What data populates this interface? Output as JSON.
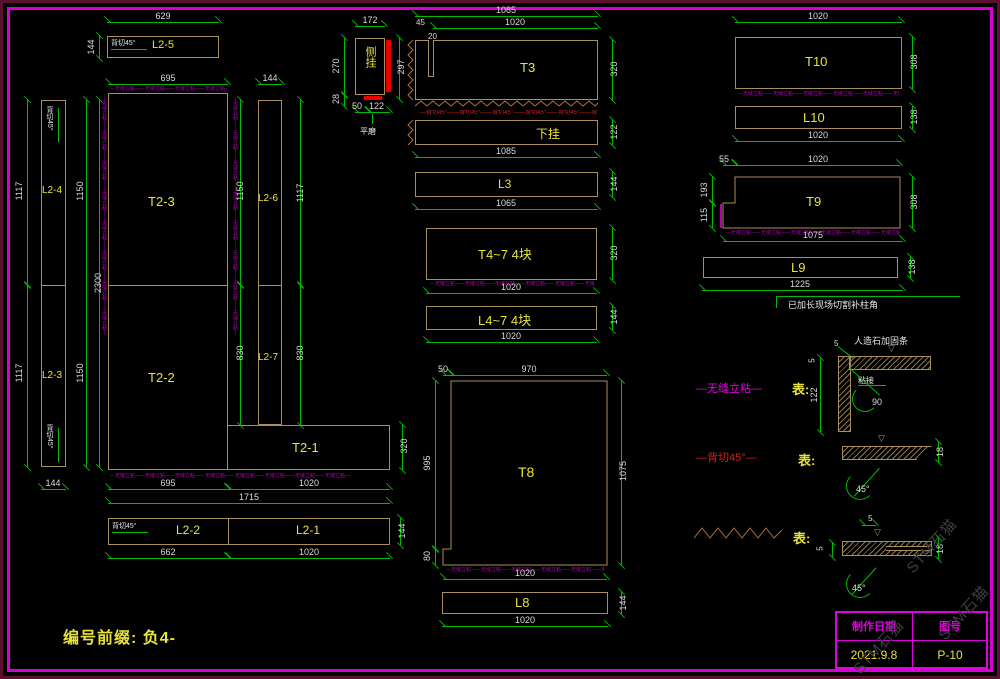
{
  "colors": {
    "background": "#000000",
    "border": "#d400d4",
    "outline": "#a98e5e",
    "dimension": "#00bb00",
    "dim_text": "#dcdcdc",
    "label": "#e8e23a",
    "seamless": "#b400b4",
    "backcut_red": "#cc2222",
    "zigzag": "#b0703a",
    "highlight_red": "#e80000"
  },
  "l25": {
    "label": "L2-5",
    "cut_note": "背切45°",
    "d629": "629",
    "d144": "144"
  },
  "leftcol": {
    "l24": "L2-4",
    "l23": "L2-3",
    "cut_note_top": "背切45°",
    "cut_note_bottom": "背切45°",
    "d1117a": "1117",
    "d1117b": "1117",
    "d2300": "2300",
    "d1150a": "1150",
    "d1150b": "1150",
    "d144": "144"
  },
  "t2": {
    "t23": "T2-3",
    "t22": "T2-2",
    "t21": "T2-1",
    "l26": "L2-6",
    "l27": "L2-7",
    "d695_top": "695",
    "d144_top": "144",
    "d1150": "1150",
    "d830a": "830",
    "d1117": "1117",
    "d830b": "830",
    "d695_bot": "695",
    "d1020_bot": "1020",
    "d1715": "1715",
    "d320": "320"
  },
  "l21row": {
    "cut_note": "背切45°",
    "l22": "L2-2",
    "l21": "L2-1",
    "d662": "662",
    "d1020": "1020",
    "d144": "144"
  },
  "cegua": {
    "label": "侧挂",
    "d172": "172",
    "d270": "270",
    "d297": "297",
    "d28": "28",
    "d50": "50",
    "d122": "122",
    "pingmo": "平磨"
  },
  "t3": {
    "label": "T3",
    "d1085": "1085",
    "d1020": "1020",
    "d45": "45",
    "d20": "20",
    "d320": "320"
  },
  "xiagua": {
    "label": "下挂",
    "d122": "122",
    "d1085": "1085"
  },
  "l3": {
    "label": "L3",
    "d144": "144",
    "d1065": "1065"
  },
  "t47": {
    "label": "T4~7  4块",
    "d320": "320",
    "d1020": "1020"
  },
  "l47": {
    "label": "L4~7  4块",
    "d144": "144",
    "d1020": "1020"
  },
  "t8": {
    "label": "T8",
    "d50": "50",
    "d970": "970",
    "d995": "995",
    "d80": "80",
    "d1075": "1075",
    "d1020": "1020"
  },
  "l8": {
    "label": "L8",
    "d144": "144",
    "d1020": "1020"
  },
  "t10": {
    "label": "T10",
    "d1020": "1020",
    "d308": "308"
  },
  "l10": {
    "label": "L10",
    "d138": "138",
    "d1020": "1020"
  },
  "t9": {
    "label": "T9",
    "d55": "55",
    "d1020": "1020",
    "d193": "193",
    "d115": "115",
    "d308": "308",
    "d1075": "1075"
  },
  "l9": {
    "label": "L9",
    "d138": "138",
    "d1225": "1225",
    "note": "已加长现场切割补柱角"
  },
  "legend": {
    "seamless": {
      "tag": "—无缝立粘—",
      "means": "表:",
      "leader": "人造石加固条",
      "glue": "粘接",
      "d5a": "5",
      "d5b": "5",
      "d122": "122",
      "d90": "90"
    },
    "backcut": {
      "tag": "—背切45°—",
      "means": "表:",
      "d18": "18",
      "d45": "45°"
    },
    "zig": {
      "means": "表:",
      "d5a": "5",
      "d5b": "5",
      "d18": "18",
      "d45": "45°"
    }
  },
  "micro": {
    "seam": "—无缝立粘——无缝立粘——无缝立粘——无缝立粘——无缝立粘——无缝立粘——无缝立粘——无缝立粘—",
    "back": "—背切45°——背切45°——背切45°——背切45°——背切45°——背切45°—"
  },
  "footer": {
    "prefix": "编号前缀: 负4-"
  },
  "titleblock": {
    "h1": "制作日期",
    "h2": "图号",
    "date": "2021.9.8",
    "no": "P-10"
  },
  "watermark": {
    "text": "STM石猫"
  }
}
